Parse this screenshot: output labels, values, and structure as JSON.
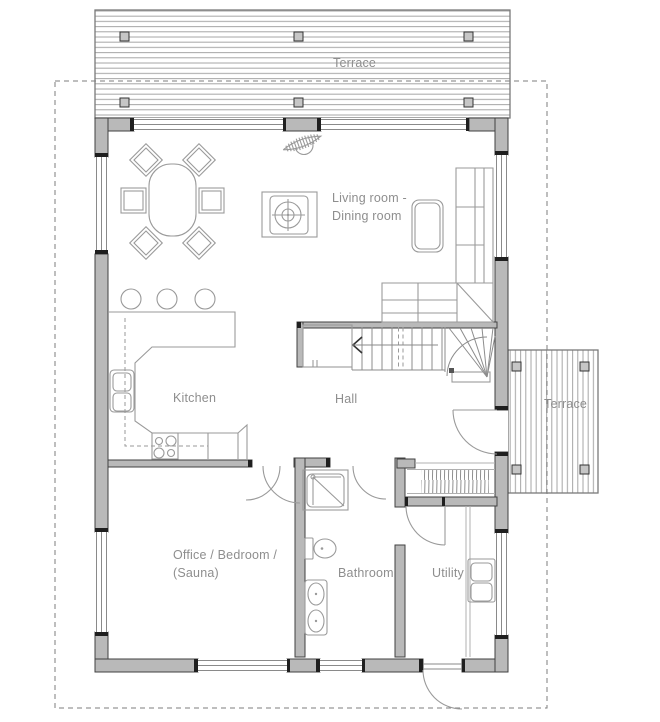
{
  "title": "House floor plan",
  "labels": {
    "terrace_top": "Terrace",
    "terrace_right": "Terrace",
    "living_dining": "Living room -\nDining room",
    "kitchen": "Kitchen",
    "hall": "Hall",
    "office": "Office / Bedroom /\n(Sauna)",
    "bathroom": "Bathroom",
    "utility": "Utility"
  },
  "colors": {
    "wall_fill": "#b9b9b9",
    "wall_edge": "#414141",
    "cap": "#1f1f1f",
    "line": "#9a9a9a",
    "line_light": "#b0b0b0",
    "stripe": "#a6a6a6",
    "dash": "#7e7e7e",
    "text": "#8e8e8e",
    "terrace_border": "#7a7a7a",
    "post_fill": "#c6c6c6"
  }
}
